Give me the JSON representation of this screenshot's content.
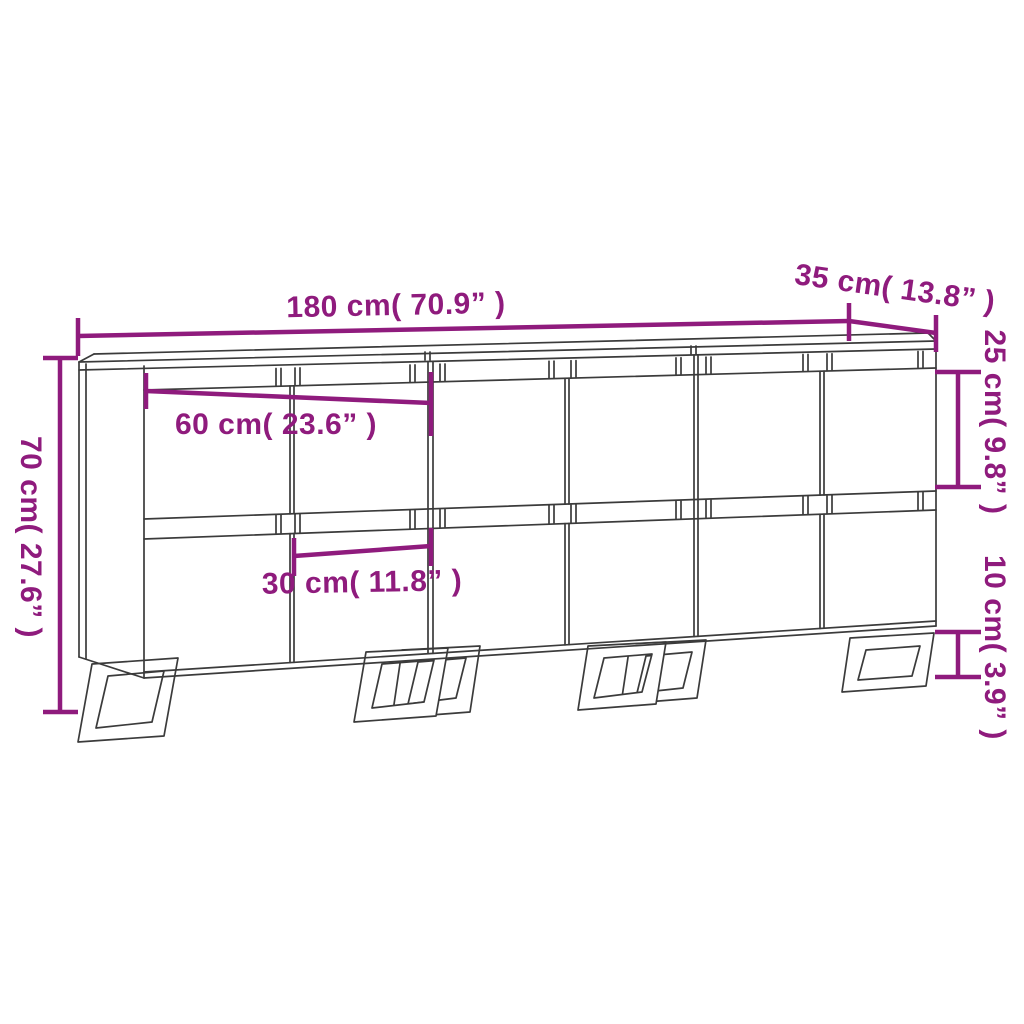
{
  "diagram": {
    "type": "furniture-dimension-drawing",
    "product": "Sideboard set, 3 pieces, line drawing with metal sled legs",
    "units": "cm (inch)",
    "colors": {
      "dimension_accent": "#8F1B7D",
      "line_art": "#3B3B3B",
      "background": "#FFFFFF"
    },
    "dimensions": {
      "total_width": {
        "label": "180 cm( 70.9” )",
        "cm": 180,
        "inch": 70.9,
        "orientation": "horizontal",
        "measures": "total width of three sideboards"
      },
      "depth": {
        "label": "35 cm( 13.8” )",
        "cm": 35,
        "inch": 13.8,
        "orientation": "slanted",
        "measures": "depth of top"
      },
      "total_height": {
        "label": "70 cm( 27.6” )",
        "cm": 70,
        "inch": 27.6,
        "orientation": "vertical",
        "measures": "total height"
      },
      "upper_door_height": {
        "label": "25 cm( 9.8” )",
        "cm": 25,
        "inch": 9.8,
        "orientation": "vertical",
        "measures": "upper door height"
      },
      "leg_height": {
        "label": "10 cm( 3.9” )",
        "cm": 10,
        "inch": 3.9,
        "orientation": "vertical",
        "measures": "leg height"
      },
      "unit_width": {
        "label": "60 cm( 23.6” )",
        "cm": 60,
        "inch": 23.6,
        "orientation": "horizontal",
        "measures": "width of one sideboard"
      },
      "door_width": {
        "label": "30 cm( 11.8” )",
        "cm": 30,
        "inch": 11.8,
        "orientation": "horizontal",
        "measures": "width of one door"
      }
    }
  }
}
